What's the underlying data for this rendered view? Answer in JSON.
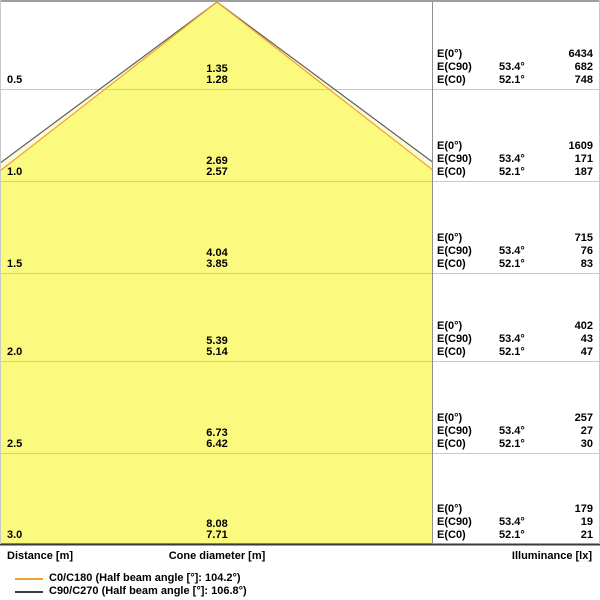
{
  "chart_data": {
    "type": "area",
    "title": "Luminous cone diagram",
    "xlabel": "Distance [m]",
    "center_label": "Cone diameter [m]",
    "right_label": "Illuminance [lx]",
    "distances_m": [
      0.5,
      1.0,
      1.5,
      2.0,
      2.5,
      3.0
    ],
    "e0_illuminance_lx": [
      6434,
      1609,
      715,
      402,
      257,
      179
    ],
    "series": [
      {
        "name": "C0/C180",
        "half_beam_angle_deg": 104.2,
        "half_angle_deg": 52.1,
        "color": "#EFA32F",
        "cone_diameter_m": [
          1.28,
          2.57,
          3.85,
          5.14,
          6.42,
          7.71
        ],
        "illuminance_lx": [
          748,
          187,
          83,
          47,
          30,
          21
        ]
      },
      {
        "name": "C90/C270",
        "half_beam_angle_deg": 106.8,
        "half_angle_deg": 53.4,
        "color": "#5F5F58",
        "cone_diameter_m": [
          1.35,
          2.69,
          4.04,
          5.39,
          6.73,
          8.08
        ],
        "illuminance_lx": [
          682,
          171,
          76,
          43,
          27,
          19
        ]
      }
    ],
    "colors": {
      "cone_fill": "#FBF97E",
      "cone_fill_outer": "#FCFBD9",
      "grid_line": "#C9C9C9",
      "baseline": "#3A3A3A",
      "separator": "#8F8F8F",
      "top_border": "#9E9E9E"
    },
    "legend_position": "bottom-left",
    "grid": true
  },
  "labels": {
    "e0": "E(0°)",
    "ec90": "E(C90)",
    "ec0": "E(C0)",
    "angle_c90": "53.4°",
    "angle_c0": "52.1°"
  },
  "sections": [
    {
      "distance": "0.5",
      "dia_c90": "1.35",
      "dia_c0": "1.28",
      "e0": "6434",
      "ec90": "682",
      "ec0": "748"
    },
    {
      "distance": "1.0",
      "dia_c90": "2.69",
      "dia_c0": "2.57",
      "e0": "1609",
      "ec90": "171",
      "ec0": "187"
    },
    {
      "distance": "1.5",
      "dia_c90": "4.04",
      "dia_c0": "3.85",
      "e0": "715",
      "ec90": "76",
      "ec0": "83"
    },
    {
      "distance": "2.0",
      "dia_c90": "5.39",
      "dia_c0": "5.14",
      "e0": "402",
      "ec90": "43",
      "ec0": "47"
    },
    {
      "distance": "2.5",
      "dia_c90": "6.73",
      "dia_c0": "6.42",
      "e0": "257",
      "ec90": "27",
      "ec0": "30"
    },
    {
      "distance": "3.0",
      "dia_c90": "8.08",
      "dia_c0": "7.71",
      "e0": "179",
      "ec90": "19",
      "ec0": "21"
    }
  ],
  "footer": {
    "distance": "Distance [m]",
    "cone_diameter": "Cone diameter [m]",
    "illuminance": "Illuminance [lx]"
  },
  "legend": [
    {
      "label": "C0/C180 (Half beam angle [°]: 104.2°)",
      "color": "#EFA32F"
    },
    {
      "label": "C90/C270 (Half beam angle [°]: 106.8°)",
      "color": "#3C3C3C"
    }
  ]
}
